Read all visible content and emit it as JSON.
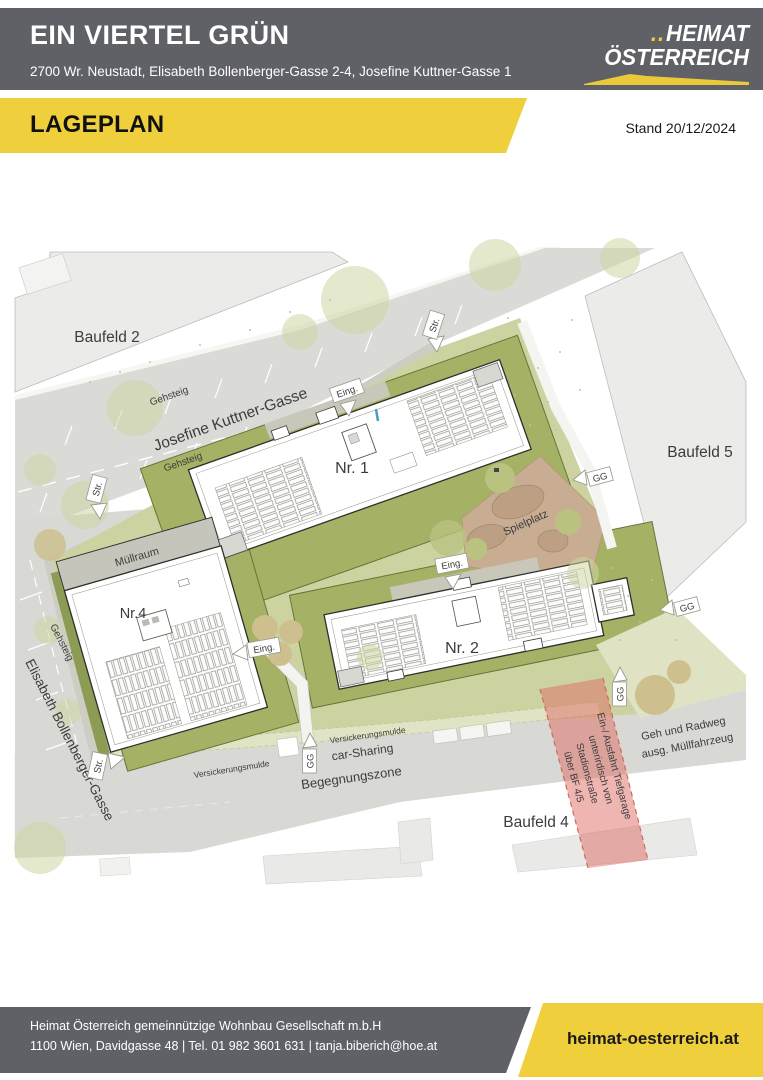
{
  "header": {
    "title": "EIN VIERTEL GRÜN",
    "address": "2700 Wr. Neustadt, Elisabeth Bollenberger-Gasse 2-4, Josefine Kuttner-Gasse 1",
    "logo": {
      "dots": "..",
      "line1": "HEIMAT",
      "line2": "ÖSTERREICH"
    }
  },
  "banner": {
    "title": "LAGEPLAN",
    "stand": "Stand 20/12/2024"
  },
  "plan": {
    "parcels": {
      "baufeld2": "Baufeld 2",
      "baufeld4": "Baufeld 4",
      "baufeld5": "Baufeld 5"
    },
    "streets": {
      "josefine_kuttner_gasse": "Josefine Kuttner-Gasse",
      "elisabeth_bollenberger_gasse": "Elisabeth Bollenberger-Gasse",
      "begegnungszone": "Begegnungszone",
      "gehsteig": "Gehsteig",
      "geh_und_radweg_line1": "Geh und Radweg",
      "geh_und_radweg_line2": "ausg. Müllfahrzeug"
    },
    "buildings": {
      "nr1": "Nr. 1",
      "nr2": "Nr. 2",
      "nr4": "Nr.4",
      "muellraum": "Müllraum"
    },
    "areas": {
      "spielplatz": "Spielplatz",
      "versickerungsmulde": "Versickerungsmulde",
      "car_sharing": "car-Sharing"
    },
    "markers": {
      "eingang": "Eing.",
      "strasse": "Str.",
      "gg": "GG"
    },
    "tiefgarage": {
      "line1": "Ein-/ Ausfahrt Tiefgarage",
      "line2": "unterirdisch von",
      "line3": "Stadionstraße",
      "line4": "über BF 4/5"
    }
  },
  "footer": {
    "company": "Heimat Österreich gemeinnützige Wohnbau Gesellschaft m.b.H",
    "contact": "1100 Wien, Davidgasse 48 | Tel. 01 982 3601 631 | tanja.biberich@hoe.at",
    "website": "heimat-oesterreich.at"
  },
  "colors": {
    "brand_yellow": "#f0cf3c",
    "header_gray": "#606166",
    "site_green": "#a5b164",
    "light_green": "#ccd3a0",
    "street_gray": "#dadbd7",
    "parcel_gray": "#ebebe9",
    "garage_red": "#dd6c63",
    "spielplatz_tan": "#c9ad93"
  }
}
